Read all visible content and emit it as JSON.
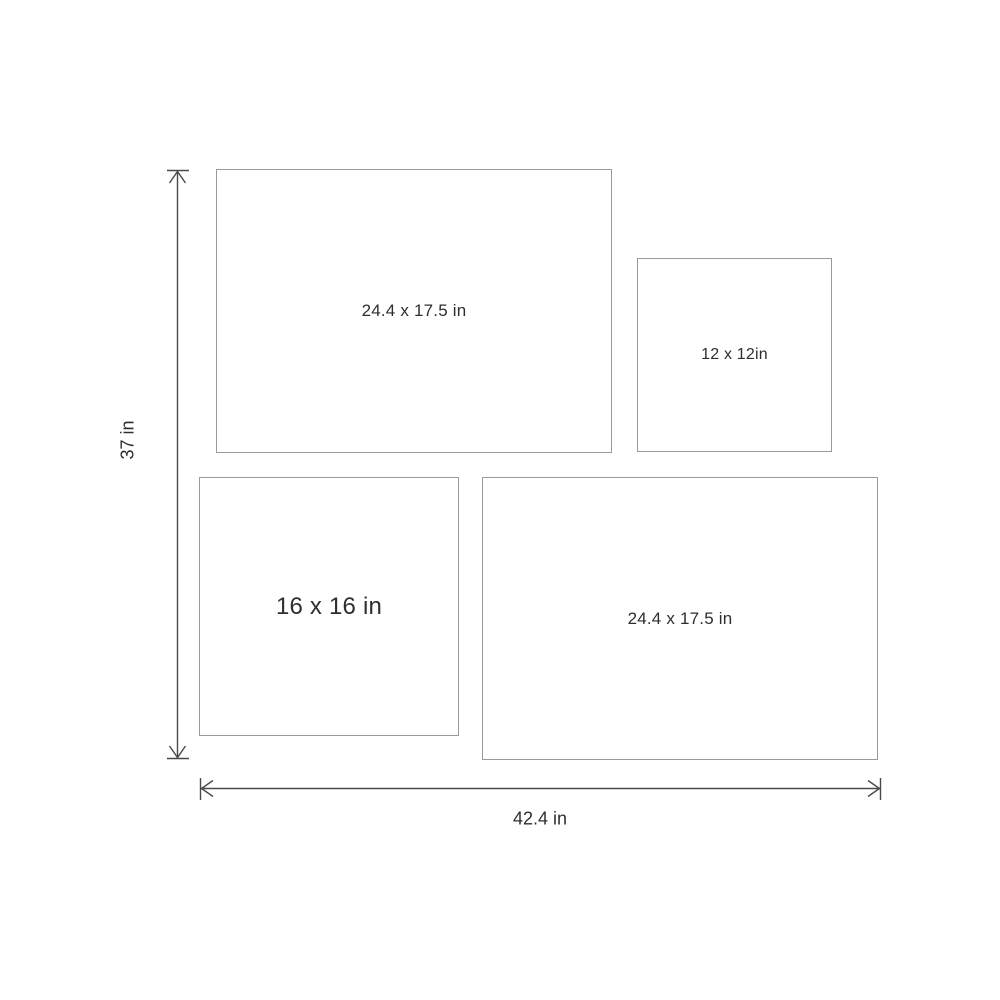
{
  "diagram": {
    "title": "canvas-set-size-diagram",
    "boxes": [
      {
        "id": "top-left",
        "label": "24.4 x 17.5 in"
      },
      {
        "id": "top-right",
        "label": "12 x 12in"
      },
      {
        "id": "bottom-left",
        "label": "16 x 16 in"
      },
      {
        "id": "bottom-right",
        "label": "24.4 x 17.5 in"
      }
    ],
    "dimensions": {
      "height_label": "37 in",
      "width_label": "42.4 in"
    },
    "colors": {
      "background": "#ffffff",
      "box_border": "#9a9a9a",
      "arrow_stroke": "#4a4a4a",
      "text": "#2e2e2e"
    }
  }
}
